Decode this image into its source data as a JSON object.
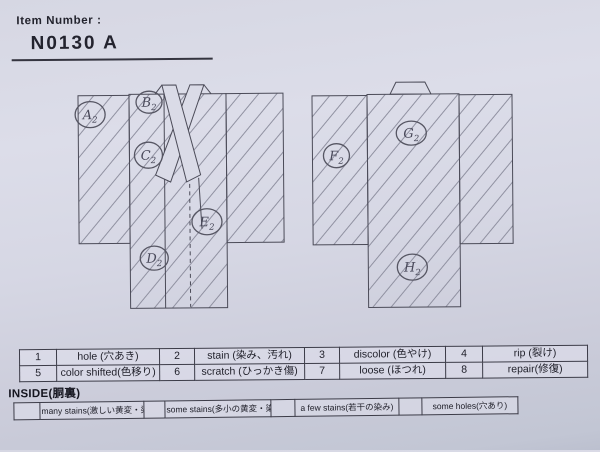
{
  "header": {
    "label": "Item Number :",
    "item_number": "N0130  A"
  },
  "markers": [
    {
      "letter": "A",
      "sub": "2",
      "x": 91,
      "y": 113,
      "rx": 15,
      "ry": 13
    },
    {
      "letter": "B",
      "sub": "2",
      "x": 150,
      "y": 101,
      "rx": 13,
      "ry": 11
    },
    {
      "letter": "C",
      "sub": "2",
      "x": 149,
      "y": 154,
      "rx": 14,
      "ry": 13
    },
    {
      "letter": "D",
      "sub": "2",
      "x": 154,
      "y": 257,
      "rx": 14,
      "ry": 12
    },
    {
      "letter": "E",
      "sub": "2",
      "x": 207,
      "y": 221,
      "rx": 15,
      "ry": 13
    },
    {
      "letter": "F",
      "sub": "2",
      "x": 337,
      "y": 156,
      "rx": 13,
      "ry": 12
    },
    {
      "letter": "G",
      "sub": "2",
      "x": 412,
      "y": 134,
      "rx": 15,
      "ry": 12
    },
    {
      "letter": "H",
      "sub": "2",
      "x": 412,
      "y": 268,
      "rx": 15,
      "ry": 13
    }
  ],
  "legend": {
    "rows": [
      [
        {
          "num": "1",
          "label": "hole (穴あき)"
        },
        {
          "num": "2",
          "label": "stain (染み、汚れ)"
        },
        {
          "num": "3",
          "label": "discolor (色やけ)"
        },
        {
          "num": "4",
          "label": "rip (裂け)"
        }
      ],
      [
        {
          "num": "5",
          "label": "color shifted(色移り)"
        },
        {
          "num": "6",
          "label": "scratch (ひっかき傷)"
        },
        {
          "num": "7",
          "label": "loose (ほつれ)"
        },
        {
          "num": "8",
          "label": "repair(修復)"
        }
      ]
    ]
  },
  "inside": {
    "title": "INSIDE(胴裏)",
    "options": [
      "many stains(激しい黄変・染み)",
      "some stains(多小の黄変・染み)",
      "a few stains(若干の染み)",
      "some holes(穴あり)"
    ]
  }
}
